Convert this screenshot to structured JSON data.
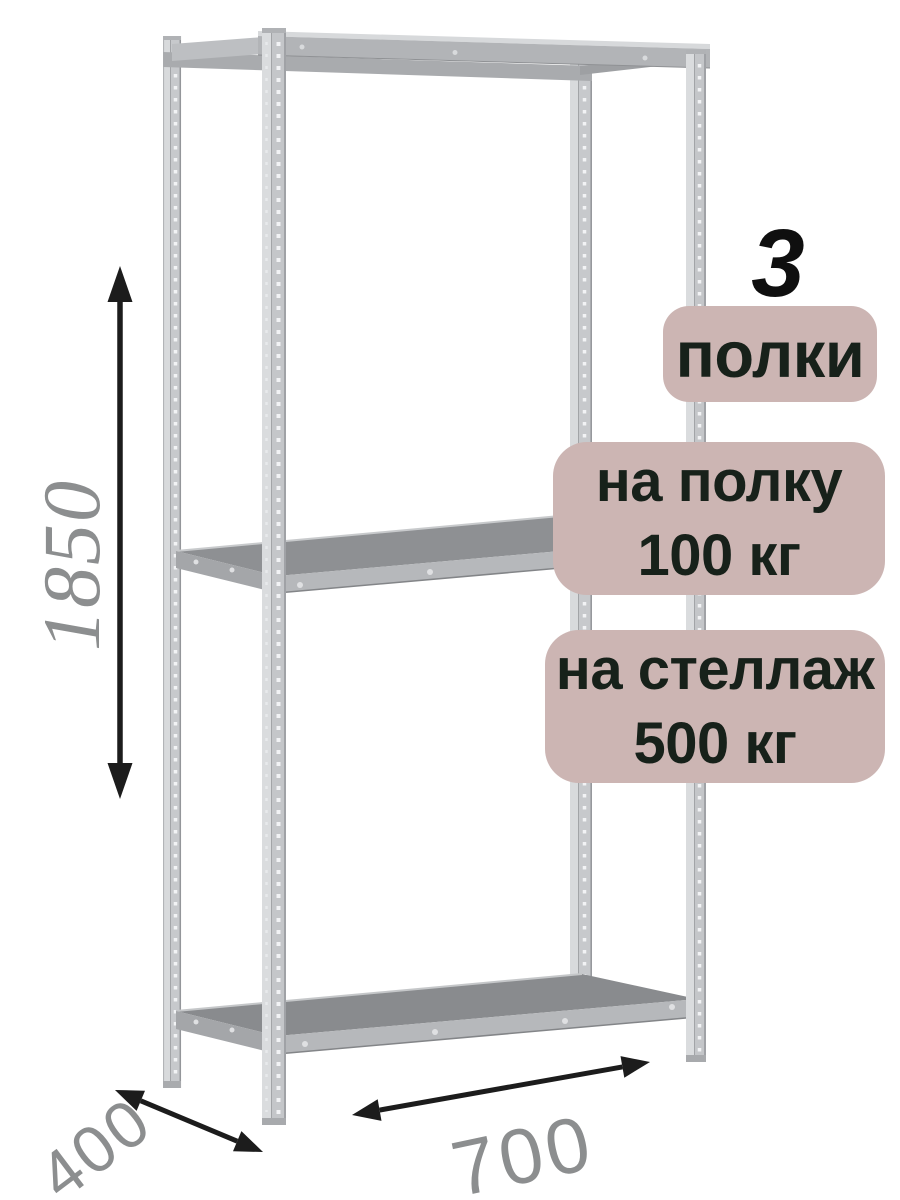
{
  "badges": {
    "shelf_count": {
      "number": "3",
      "label": "полки"
    },
    "shelf_load": {
      "line1": "на полку",
      "line2": "100 кг"
    },
    "rack_load": {
      "line1": "на стеллаж",
      "line2": "500 кг"
    }
  },
  "dimensions": {
    "height_mm": "1850",
    "depth_mm": "400",
    "width_mm": "700"
  },
  "colors": {
    "badge_background": "#ccb5b3",
    "badge_text": "#17211a",
    "dimension_text": "#8c8e8f",
    "arrow": "#1c1c1c",
    "metal_light": "#d8dadc",
    "metal_mid": "#b4b6b9",
    "shelf_surface": "#898b8e",
    "background": "#ffffff"
  }
}
